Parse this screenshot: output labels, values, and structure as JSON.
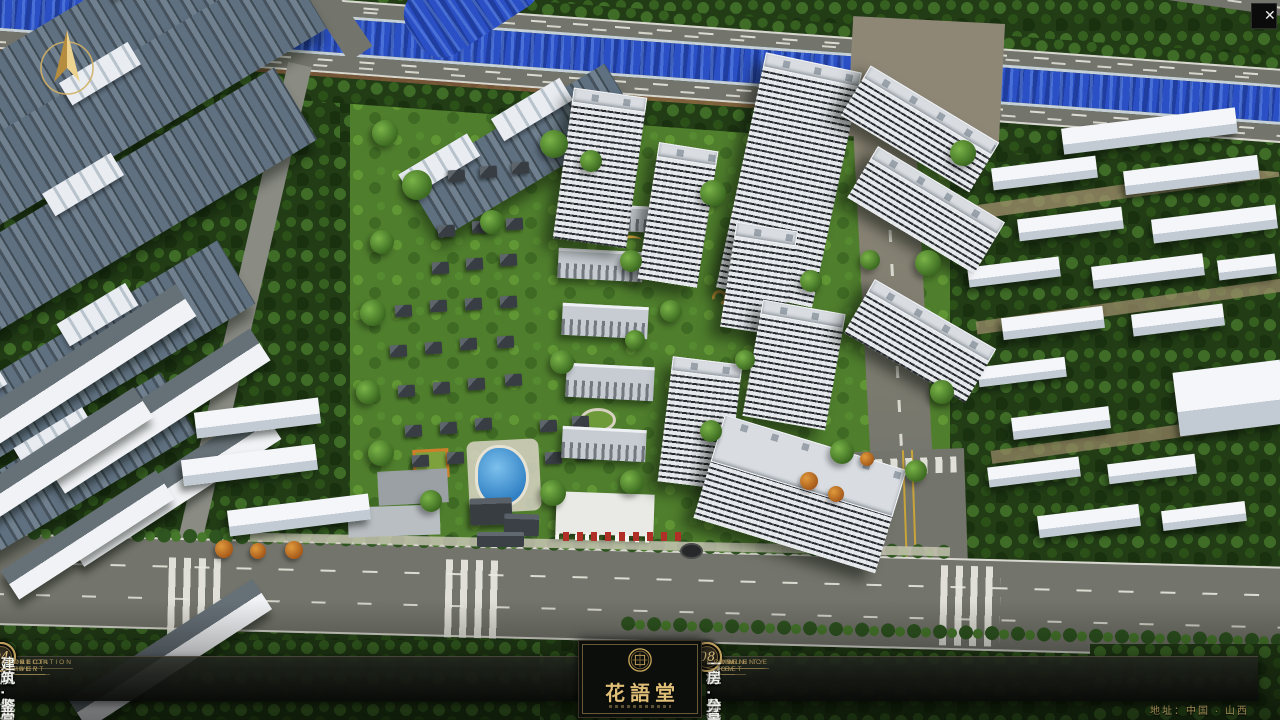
{
  "window": {
    "close_icon": "✕"
  },
  "logo": {
    "title": "花語堂"
  },
  "nav": {
    "items": [
      {
        "num": "01",
        "zh": "品牌·介绍",
        "en": "BRAND SUPPORT"
      },
      {
        "num": "02",
        "zh": "区位·价值",
        "en": "LOCATION VALUE"
      },
      {
        "num": "03",
        "zh": "项目·概况",
        "en": "PROJECT SURVEY"
      },
      {
        "num": "04",
        "zh": "建筑·鉴赏",
        "en": "APPRECIATION"
      },
      {
        "num": "05",
        "zh": "园林·景观",
        "en": "GARDEN STREET"
      },
      {
        "num": "06",
        "zh": "精装·体验",
        "en": "EXPERIENCE"
      },
      {
        "num": "07",
        "zh": "户型·分布",
        "en": "SHOW ROOM"
      },
      {
        "num": "08",
        "zh": "一房·一景",
        "en": "COMMUNITY"
      }
    ]
  },
  "footer": {
    "address": "地址：中国 · 山西"
  },
  "colors": {
    "accent_gold": "#c9a85c",
    "nav_background": "#0c0e0b",
    "river_blue": "#2b50c6",
    "lawn_green": "#4f7e2d",
    "road_gray": "#73746b"
  }
}
